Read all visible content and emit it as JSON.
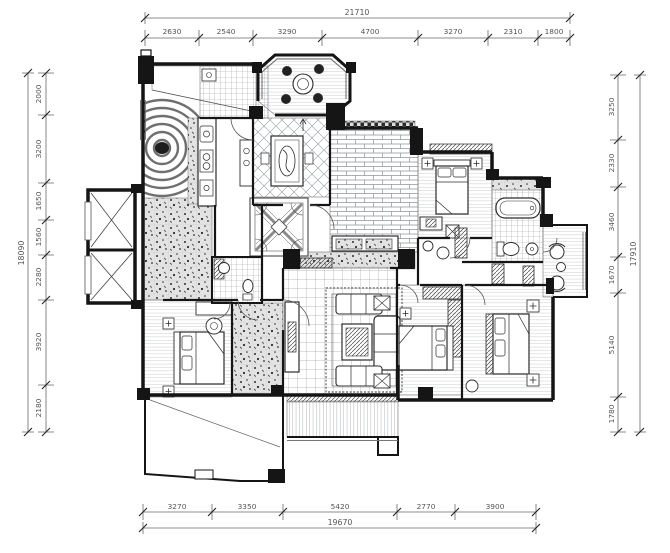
{
  "drawing": {
    "kind": "apartment floor plan (architectural line drawing, black/white)",
    "units": "mm"
  },
  "colors": {
    "background": "#ffffff",
    "wall": "#151515",
    "line": "#444444",
    "dim_text": "#555555",
    "pattern": "#8b8f96"
  },
  "dimensions": {
    "top": {
      "total": "21710",
      "segments": [
        "2630",
        "2540",
        "3290",
        "4700",
        "3270",
        "2310",
        "1800"
      ]
    },
    "bottom": {
      "total": "19670",
      "segments": [
        "3270",
        "3350",
        "5420",
        "2770",
        "3900"
      ]
    },
    "left": {
      "total": "18090",
      "segments": [
        "2000",
        "3200",
        "1650",
        "1560",
        "2280",
        "3920",
        "2180"
      ]
    },
    "right": {
      "total": "17910",
      "segments": [
        "3250",
        "2330",
        "3460",
        "1670",
        "5140",
        "1780"
      ]
    }
  }
}
